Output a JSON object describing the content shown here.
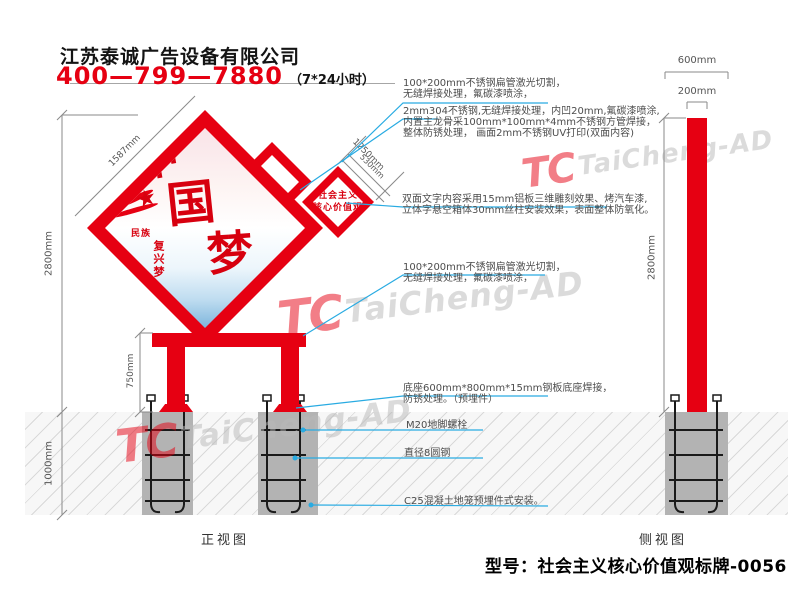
{
  "header": {
    "company": "江苏泰诚广告设备有限公司",
    "phone": "400—799—7880",
    "hours": "（7*24小时）"
  },
  "front_view": {
    "label": "正视图",
    "dims": {
      "total_height": "2800mm",
      "underground_depth": "1000mm",
      "stand_height": "750mm",
      "panel_edge": "1587mm",
      "plaque_edge": "1250mm",
      "plaque_edge_minor": "530mm"
    },
    "artwork": {
      "char_zhong": "中",
      "char_guo": "国",
      "char_meng": "梦",
      "star": "★",
      "seal_a": "民族",
      "seal_b": "复兴梦"
    },
    "plaque": {
      "line1": "社会主义",
      "line2": "核心价值观"
    }
  },
  "side_view": {
    "label": "侧视图",
    "dims": {
      "base_width": "600mm",
      "post_width": "200mm",
      "height": "2800mm"
    }
  },
  "annotations": [
    {
      "lines": [
        "100*200mm不锈钢扁管激光切割，",
        "无缝焊接处理，氟碳漆喷涂，"
      ]
    },
    {
      "lines": [
        "2mm304不锈钢,无缝焊接处理，内凹20mm,氟碳漆喷涂,",
        "内置主龙骨采100mm*100mm*4mm不锈钢方管焊接，",
        "整体防锈处理， 画面2mm不锈钢UV打印(双面内容)"
      ]
    },
    {
      "lines": [
        "双面文字内容采用15mm铝板三维雕刻效果、烤汽车漆,",
        "立体字悬空箱体30mm丝柱安装效果，表面整体防氧化。"
      ]
    },
    {
      "lines": [
        "100*200mm不锈钢扁管激光切割，",
        "无缝焊接处理，氟碳漆喷涂，"
      ]
    },
    {
      "lines": [
        "底座600mm*800mm*15mm钢板底座焊接，",
        "防锈处理。（预埋件）"
      ]
    },
    {
      "lines": [
        "M20地脚螺栓"
      ]
    },
    {
      "lines": [
        "直径8圆钢"
      ]
    },
    {
      "lines": [
        "C25混凝土地笼预埋件式安装。"
      ]
    }
  ],
  "watermark": {
    "monogram": "TC",
    "brand": "TaiCheng-AD"
  },
  "footer": {
    "model": "型号：社会主义核心价值观标牌-0056"
  },
  "colors": {
    "red": "#e60012",
    "leader_blue": "#29abe2",
    "concrete": "#b3b3b3",
    "watermark_gray": "#c4c4c4"
  }
}
